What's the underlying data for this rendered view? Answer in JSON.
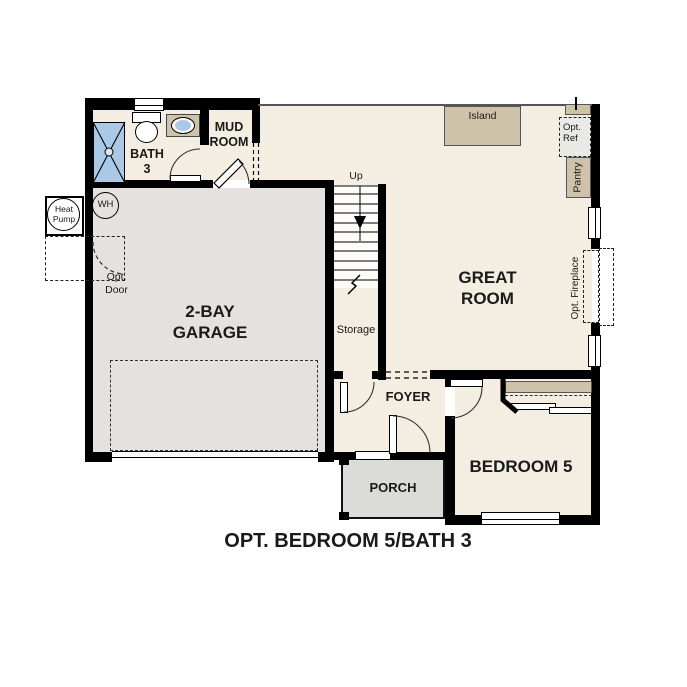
{
  "title": "OPT. BEDROOM 5/BATH 3",
  "rooms": {
    "bath3": "BATH\n3",
    "mud_room": "MUD\nROOM",
    "garage": "2-BAY\nGARAGE",
    "great_room": "GREAT\nROOM",
    "foyer": "FOYER",
    "bedroom5": "BEDROOM 5",
    "porch": "PORCH",
    "storage": "Storage"
  },
  "labels": {
    "up": "Up",
    "island": "Island",
    "pantry": "Pantry",
    "opt_ref": "Opt.\nRef",
    "opt_fireplace": "Opt. Fireplace",
    "opt_door": "Opt.\nDoor",
    "heat_pump": "Heat\nPump",
    "water_heater": "WH"
  },
  "colors": {
    "wall": "#000000",
    "floor": "#f3eee1",
    "garage_floor": "#e3e2de",
    "porch_floor": "#dbdbd7",
    "counter_tan": "#cec2a9",
    "fixture_blue": "#aac9e7",
    "opt_ref_fill": "#e9e9e6",
    "text": "#1a1a1a"
  }
}
